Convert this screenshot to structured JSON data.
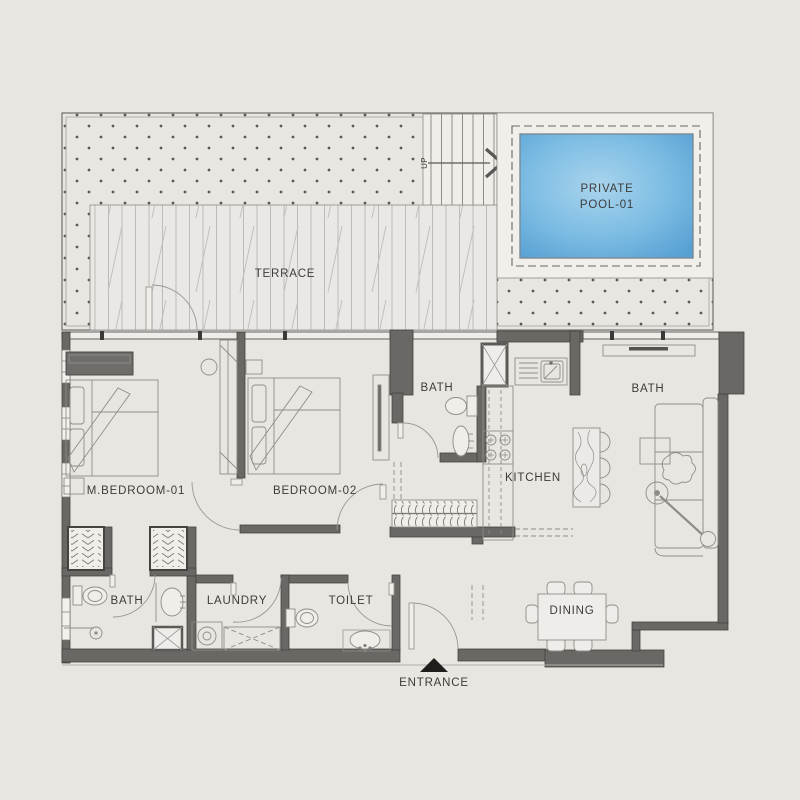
{
  "floor_plan": {
    "rooms": {
      "terrace": {
        "label": "TERRACE"
      },
      "private_pool": {
        "label_line1": "PRIVATE",
        "label_line2": "POOL-01"
      },
      "master_bedroom": {
        "label": "M.BEDROOM-01"
      },
      "bedroom_02": {
        "label": "BEDROOM-02"
      },
      "bath_bedroom02": {
        "label": "BATH"
      },
      "kitchen": {
        "label": "KITCHEN"
      },
      "living_area": {
        "label": "BATH"
      },
      "dining": {
        "label": "DINING"
      },
      "bath_master": {
        "label": "BATH"
      },
      "laundry": {
        "label": "LAUNDRY"
      },
      "toilet": {
        "label": "TOILET"
      }
    },
    "annotations": {
      "entrance": "ENTRANCE",
      "stairs_direction": "UP"
    },
    "colors": {
      "background": "#e9e6e2",
      "wall_fill": "#6a6865",
      "wall_edge": "#45433f",
      "thin_line": "#8f8d89",
      "pool_center": "#a9d4ed",
      "pool_edge": "#559fd3",
      "text": "#3d3c3a",
      "marker_dark": "#1f1e1d"
    }
  }
}
